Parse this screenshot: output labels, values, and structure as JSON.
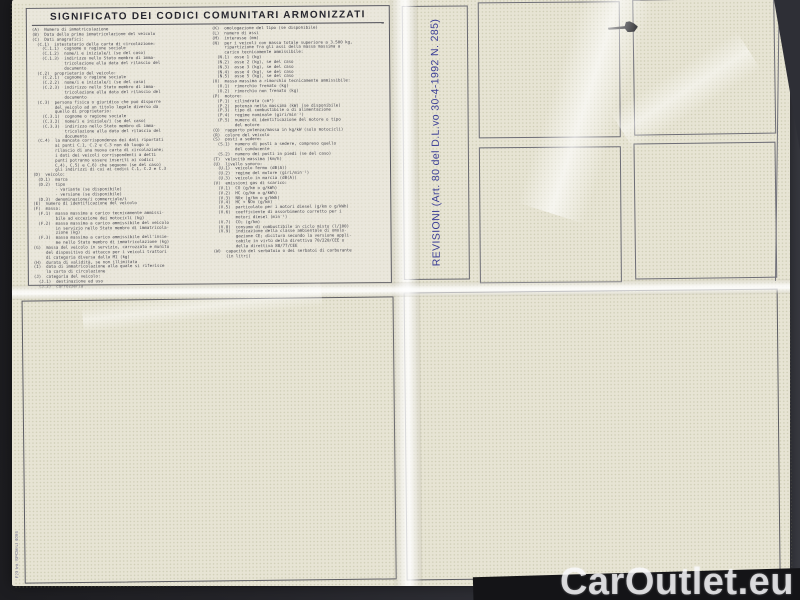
{
  "document": {
    "title": "SIGNIFICATO DEI CODICI COMUNITARI ARMONIZZATI",
    "legend": {
      "left_column": "(A)  Numero di immatricolazione\n(B)  Data della prima immatricolazione del veicolo\n(C)  Dati anagrafici:\n  (C.1)  intestatario della carta di circolazione:\n    (C.1.1)  cognome o ragione sociale\n    (C.1.2)  nome/i e iniziale/i (se del caso)\n    (C.1.3)  indirizzo nello Stato membro di imma-\n             tricolazione alla data del rilascio del\n             documento\n  (C.2)  proprietario del veicolo:\n    (C.2.1)  cognome o ragione sociale\n    (C.2.2)  nome/i e iniziale/i (se del caso)\n    (C.2.3)  indirizzo nello Stato membro di imma-\n             tricolazione alla data del rilascio del\n             documento\n  (C.3)  persona fisica o giuridica che può disporre\n         del veicolo ad un titolo legale diverso da\n         quello di proprietario:\n    (C.3.1)  cognome o ragione sociale\n    (C.3.2)  nome/i e iniziale/i (se del caso)\n    (C.3.3)  indirizzo nello Stato membro di imma-\n             tricolazione alla data del rilascio del\n             documento\n  (C.4)  la mancata corrispondenza dei dati riportati\n         ai punti C.1, C.2 e C.3 non dà luogo a\n         rilascio di una nuova carta di circolazione;\n         i dati dei veicoli corrispondenti a detti\n         punti potranno essere inseriti ai codici\n         C.4), C.5) e C.6) che seguono (se del caso)\n         gli indirizzi di cui ai codici C.1, C.2 e C.3\n(D)  veicolo:\n  (D.1)  marca\n  (D.2)  tipo\n         - variante (se disponibile)\n         - versione (se disponibile)\n  (D.3)  denominazione/i commerciale/i\n(E)  numero di identificazione del veicolo\n(F)  massa:\n  (F.1)  massa massima a carico tecnicamente ammissi-\n         bile ad eccezione dei motocicli (kg)\n  (F.2)  massa massima a carico ammissibile del veicolo\n         in servizio nello Stato membro di immatricola-\n         zione (kg)\n  (F.3)  massa massima a carico ammissibile dell'insie-\n         me nello Stato membro di immatricolazione (kg)\n(G)  massa del veicolo in servizio, carrozzato e munito\n     del dispositivo di attacco per i veicoli trattori\n     di categoria diversa dalla M1 (kg)\n(H)  durata di validità, se non illimitata\n(I)  data di immatricolazione alla quale si riferisce\n     la carta di circolazione\n(J)  categoria del veicolo:\n  (J.1)  destinazione ed uso\n  (J.2)  carrozzeria",
      "right_column": "(K)  omologazione del tipo (se disponibile)\n(L)  numero di assi\n(M)  interasse (mm)\n(N)  per i veicoli con massa totale superiore a 3.500 kg,\n     ripartizione fra gli assi della massa massima a\n     carico tecnicamente ammissibile:\n  (N.1)  asse 1 (kg)\n  (N.2)  asse 2 (kg), se del caso\n  (N.3)  asse 3 (kg), se del caso\n  (N.4)  asse 4 (kg), se del caso\n  (N.5)  asse 5 (kg), se del caso\n(O)  massa massima a rimorchio tecnicamente ammissibile:\n  (O.1)  rimorchio frenato (kg)\n  (O.2)  rimorchio non frenato (kg)\n(P)  motore:\n  (P.1)  cilindrata (cm³)\n  (P.2)  potenza netta massima (kW) (se disponibile)\n  (P.3)  tipo di combustibile o di alimentazione\n  (P.4)  regime nominale (giri/min⁻¹)\n  (P.5)  numero di identificazione del motore o tipo\n         del motore\n(Q)  rapporto potenza/massa in kg/kW (solo motocicli)\n(R)  colore del veicolo\n(S)  posti a sedere:\n  (S.1)  numero di posti a sedere, compreso quello\n         del conducente\n  (S.2)  numero dei posti in piedi (se del caso)\n(T)  velocità massima (km/h)\n(U)  livello sonoro:\n  (U.1)  veicolo fermo (dB(A))\n  (U.2)  regime del motore (giri/min⁻¹)\n  (U.3)  veicolo in marcia (dB(A))\n(V)  emissioni gas di scarico:\n  (V.1)  CO (g/km o g/kWh)\n  (V.2)  HC (g/km o g/kWh)\n  (V.3)  NOx (g/km o g/kWh)\n  (V.4)  HC + NOx (g/km)\n  (V.5)  particolato per i motori diesel (g/km o g/kWh)\n  (V.6)  coefficiente di assorbimento corretto per i\n         motori diesel (min⁻¹)\n  (V.7)  CO₂ (g/km)\n  (V.8)  consumo di combustibile in ciclo misto (l/100)\n  (V.9)  indicazione della classe ambientale di omolo-\n         gazione CE; dicitura secondo la versione appli-\n         cabile in virtù della direttiva 70/220/CEE o\n         della direttiva 88/77/CEE\n(W)  capacità del serbatoio o dei serbatoi di carburante\n     (in litri)"
    },
    "revisioni": {
      "label": "REVISIONI (Art. 80 del D.L.vo 30-4-1992 N. 285)",
      "stamp_box_count": 4
    },
    "print_code": "F23 Int. SPCM-LI 4094"
  },
  "watermark": {
    "text": "CarOutlet.eu"
  },
  "colors": {
    "background_dark": "#242429",
    "paper_cream": "#e7e4d4",
    "pattern_dot": "#94986c",
    "ink_text": "#45454f",
    "revision_blue": "#3b3e96",
    "watermark_white": "#f9f9fb"
  }
}
